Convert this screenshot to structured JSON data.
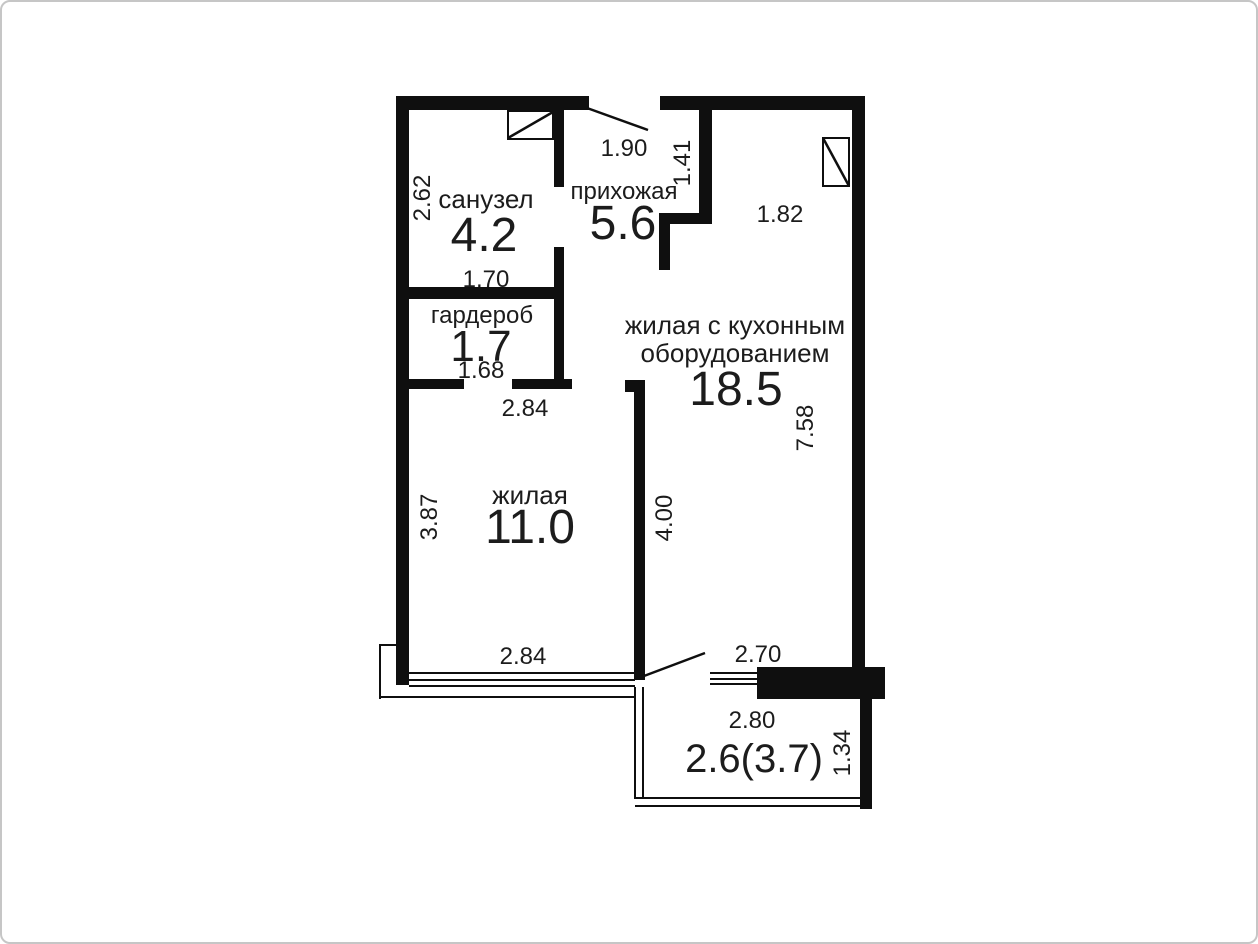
{
  "rooms": {
    "sanuzel": {
      "name": "санузел",
      "area": "4.2"
    },
    "prihozhaya": {
      "name": "прихожая",
      "area": "5.6"
    },
    "garderob": {
      "name": "гардероб",
      "area": "1.7"
    },
    "zhilaya": {
      "name": "жилая",
      "area": "11.0"
    },
    "kitchen_living": {
      "name_line1": "жилая с кухонным",
      "name_line2": "оборудованием",
      "area": "18.5"
    },
    "balcony": {
      "area": "2.6(3.7)"
    }
  },
  "dimensions": {
    "sanuzel_height": "2.62",
    "sanuzel_width": "1.70",
    "entry_width": "1.90",
    "hall_wall": "1.41",
    "kitchen_top": "1.82",
    "garderob_width": "1.68",
    "zhilaya_width_top": "2.84",
    "zhilaya_height": "3.87",
    "partition_height": "4.00",
    "kitchen_height": "7.58",
    "window_width": "2.84",
    "balcony_opening": "2.70",
    "balcony_width": "2.80",
    "balcony_depth": "1.34"
  },
  "colors": {
    "wall": "#0f0f0f",
    "text": "#1c1c1c",
    "frame_border": "#c6c6c6",
    "background": "#ffffff"
  }
}
